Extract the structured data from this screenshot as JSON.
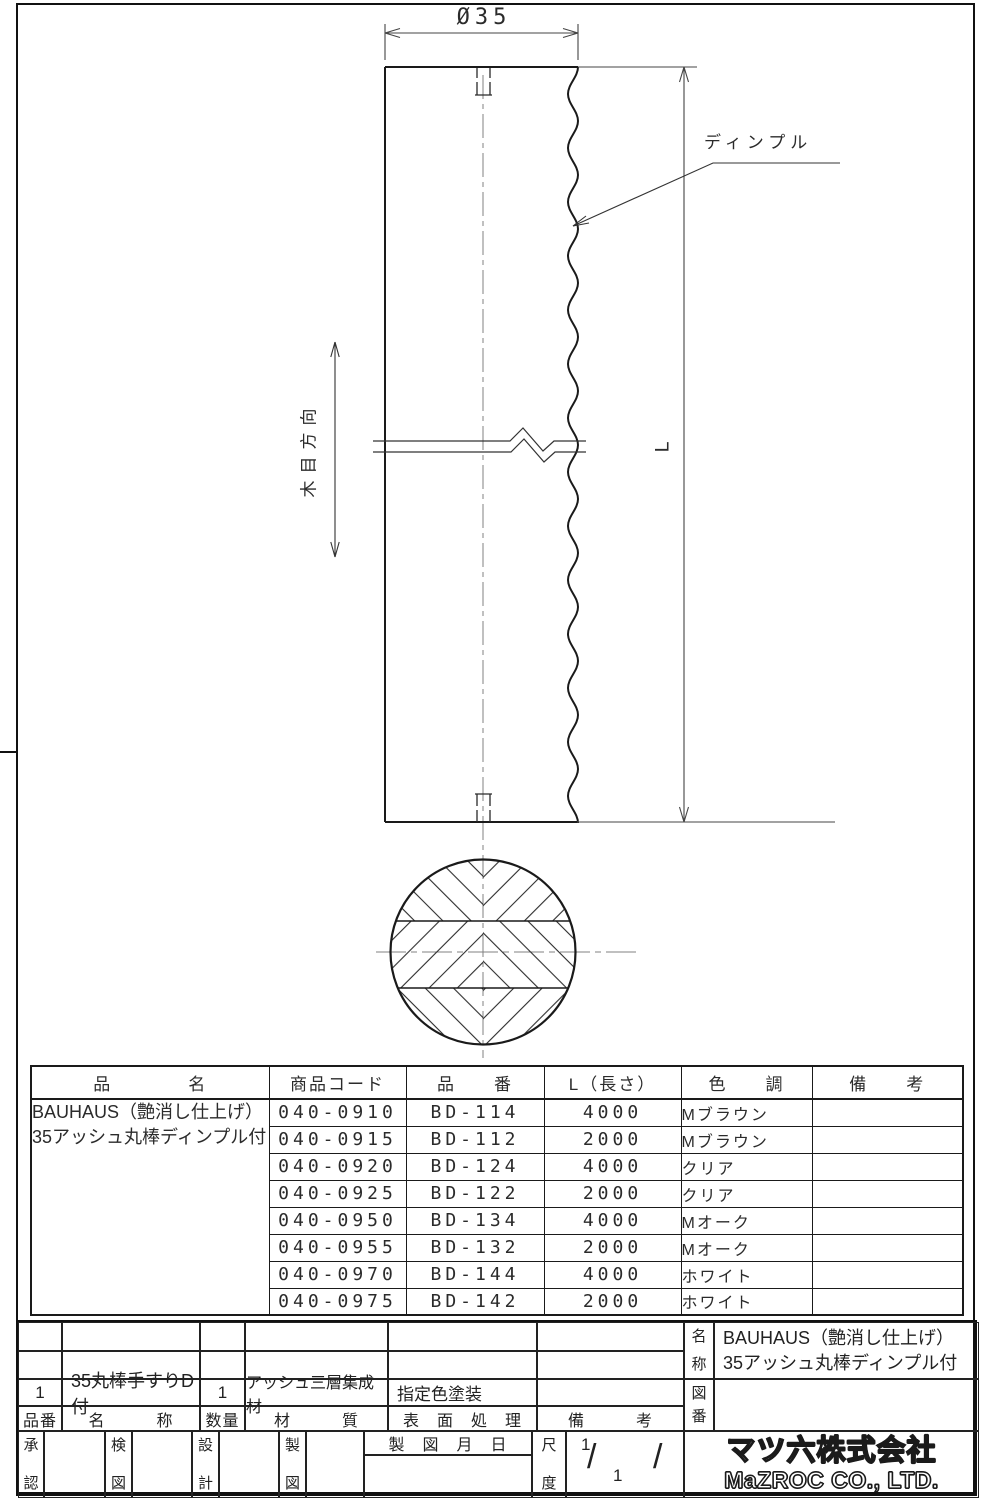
{
  "drawing": {
    "diameter_dim": "Ø35",
    "length_dim": "L",
    "dimple_label": "ディンプル",
    "grain_direction_label": "木目方向"
  },
  "parts_table": {
    "headers": {
      "product_name": "品　　　　名",
      "product_code": "商品コード",
      "part_number": "品　　番",
      "length": "L（長さ）",
      "color": "色　　調",
      "remarks": "備　　考"
    },
    "product_name_line1": "BAUHAUS（艶消し仕上げ）",
    "product_name_line2": "35アッシュ丸棒ディンプル付",
    "rows": [
      {
        "code": "040-0910",
        "part_number": "BD-114",
        "length": "4000",
        "color": "Mブラウン",
        "remarks": ""
      },
      {
        "code": "040-0915",
        "part_number": "BD-112",
        "length": "2000",
        "color": "Mブラウン",
        "remarks": ""
      },
      {
        "code": "040-0920",
        "part_number": "BD-124",
        "length": "4000",
        "color": "クリア",
        "remarks": ""
      },
      {
        "code": "040-0925",
        "part_number": "BD-122",
        "length": "2000",
        "color": "クリア",
        "remarks": ""
      },
      {
        "code": "040-0950",
        "part_number": "BD-134",
        "length": "4000",
        "color": "Mオーク",
        "remarks": ""
      },
      {
        "code": "040-0955",
        "part_number": "BD-132",
        "length": "2000",
        "color": "Mオーク",
        "remarks": ""
      },
      {
        "code": "040-0970",
        "part_number": "BD-144",
        "length": "4000",
        "color": "ホワイト",
        "remarks": ""
      },
      {
        "code": "040-0975",
        "part_number": "BD-142",
        "length": "2000",
        "color": "ホワイト",
        "remarks": ""
      }
    ]
  },
  "title_block": {
    "item": {
      "number": "1",
      "name": "35丸棒手すりD付",
      "quantity": "1",
      "material": "アッシュ三層集成材",
      "surface": "指定色塗装",
      "remarks": ""
    },
    "headers": {
      "number": "品番",
      "name": "名　　　称",
      "quantity": "数量",
      "material": "材　　　質",
      "surface": "表　面　処　理",
      "remarks": "備　　　考",
      "date": "製　図　月　日"
    },
    "name_label": [
      "名",
      "称"
    ],
    "name_value_line1": "BAUHAUS（艶消し仕上げ）",
    "name_value_line2": "35アッシュ丸棒ディンプル付",
    "drawing_no_label": [
      "図",
      "番"
    ],
    "drawing_no_value": "",
    "approval_label": [
      "承",
      "認"
    ],
    "check_label": [
      "検",
      "図"
    ],
    "design_label": [
      "設",
      "計"
    ],
    "draft_label": [
      "製",
      "図"
    ],
    "scale_label": [
      "尺",
      "度"
    ],
    "scale": {
      "numerator": "1",
      "denominator": "1",
      "slash": "/",
      "extra_slash": "/"
    },
    "company": {
      "logo_jp": "マツ六株式会社",
      "logo_en": "MaZROC CO., LTD."
    }
  }
}
